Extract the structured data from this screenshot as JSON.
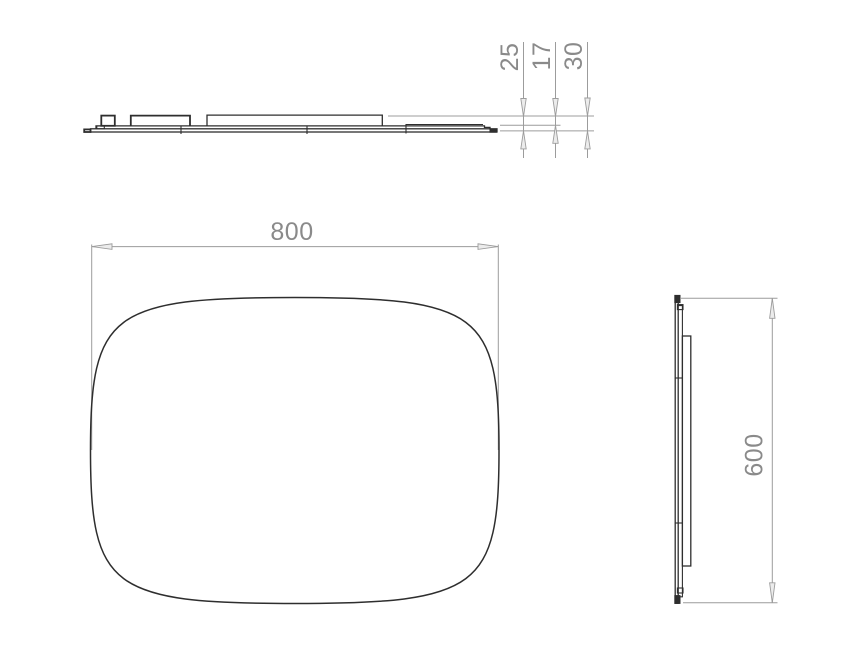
{
  "drawing": {
    "type": "technical-drawing",
    "views": {
      "top_profile": {
        "depth_dimensions": [
          {
            "value": "25"
          },
          {
            "value": "17"
          },
          {
            "value": "30"
          }
        ]
      },
      "front": {
        "width_dimension": {
          "value": "800"
        }
      },
      "right_profile": {
        "height_dimension": {
          "value": "600"
        }
      }
    }
  },
  "colors": {
    "part_line": "#2e2e2e",
    "dimension_line": "#9c9c9c",
    "dimension_text": "#8a8a8a",
    "arrow_fill": "#ececec",
    "background": "#ffffff"
  }
}
